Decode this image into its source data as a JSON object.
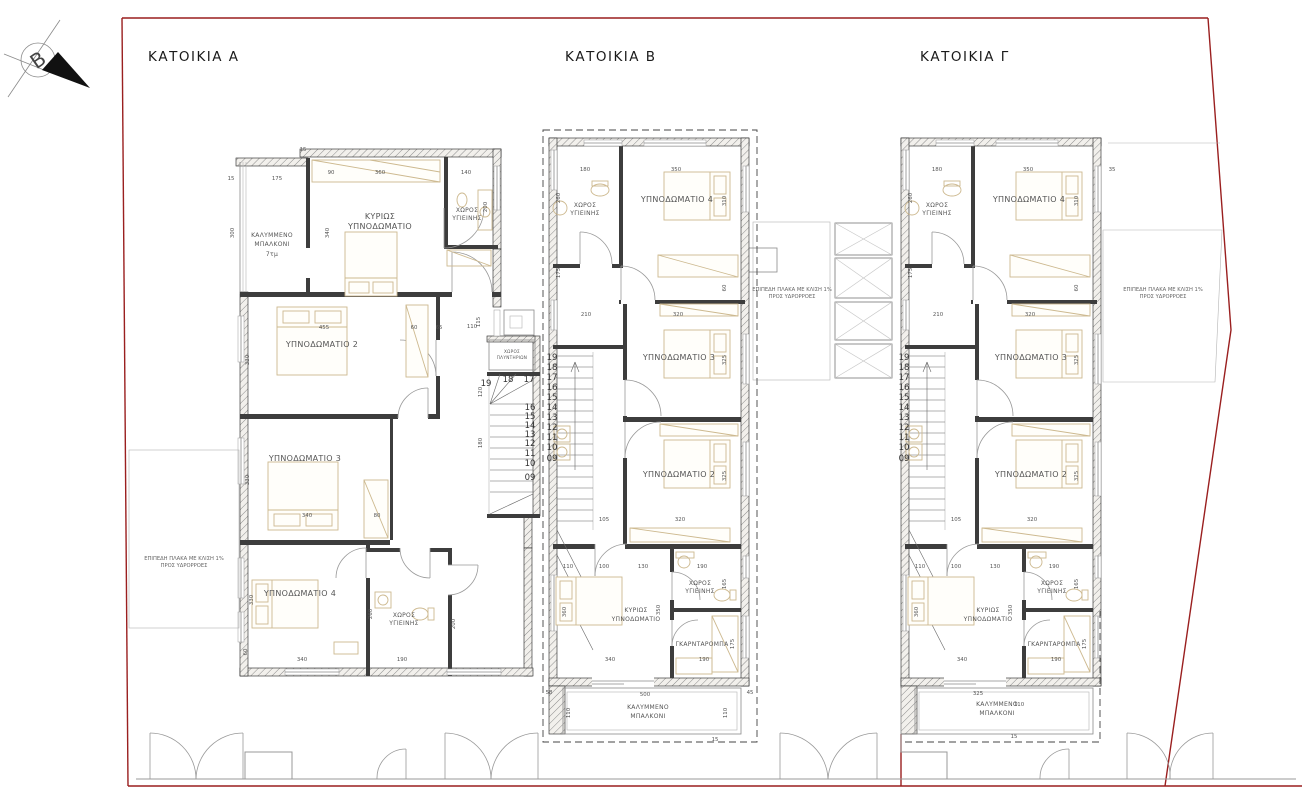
{
  "page": {
    "background": "#ffffff",
    "boundary_color": "#9a1f1f",
    "wall_color": "#3d3d3d",
    "furniture_color": "#cdb98f"
  },
  "north_arrow": {
    "label": "Β"
  },
  "houses": {
    "a": {
      "title": "ΚΑΤΟΙΚΙΑ Α"
    },
    "b": {
      "title": "ΚΑΤΟΙΚΙΑ Β"
    },
    "c": {
      "title": "ΚΑΤΟΙΚΙΑ Γ"
    }
  },
  "labels": {
    "covered_balcony_1": "ΚΑΛΥΜΜΕΝΟ",
    "covered_balcony_2": "ΜΠΑΛΚΟΝΙ",
    "balcony_area_a": "7τμ",
    "master_1": "ΚΥΡΙΩΣ",
    "master_2": "ΥΠΝΟΔΩΜΑΤΙΟ",
    "bath_1": "ΧΩΡΟΣ",
    "bath_2": "ΥΓΙΕΙΝΗΣ",
    "bedroom2": "ΥΠΝΟΔΩΜΑΤΙΟ 2",
    "bedroom3": "ΥΠΝΟΔΩΜΑΤΙΟ 3",
    "bedroom4": "ΥΠΝΟΔΩΜΑΤΙΟ 4",
    "wardrobe": "ΓΚΑΡΝΤΑΡΟΜΠΑ",
    "laundry_1": "ΧΩΡΟΣ",
    "laundry_2": "ΠΛΥΝΤΗΡΙΩΝ",
    "flat_slab_1": "ΕΠΙΠΕΔΗ ΠΛΑΚΑ ΜΕ ΚΛΙΣΗ 1%",
    "flat_slab_2": "ΠΡΟΣ ΥΔΡΟΡΡΟΕΣ"
  },
  "stairs": {
    "numbers": [
      "19",
      "18",
      "17",
      "16",
      "15",
      "14",
      "13",
      "12",
      "11",
      "10",
      "09"
    ]
  },
  "dimensions": {
    "a": [
      {
        "t": "15",
        "x": 231,
        "y": 180
      },
      {
        "t": "175",
        "x": 277,
        "y": 180
      },
      {
        "t": "15",
        "x": 303,
        "y": 151
      },
      {
        "t": "90",
        "x": 331,
        "y": 174
      },
      {
        "t": "360",
        "x": 380,
        "y": 174
      },
      {
        "t": "140",
        "x": 466,
        "y": 174
      },
      {
        "t": "300",
        "x": 234,
        "y": 233,
        "v": 1
      },
      {
        "t": "340",
        "x": 329,
        "y": 233,
        "v": 1
      },
      {
        "t": "200",
        "x": 487,
        "y": 207,
        "v": 1
      },
      {
        "t": "455",
        "x": 324,
        "y": 329
      },
      {
        "t": "60",
        "x": 414,
        "y": 329
      },
      {
        "t": "65",
        "x": 439,
        "y": 329
      },
      {
        "t": "110",
        "x": 472,
        "y": 328
      },
      {
        "t": "330",
        "x": 249,
        "y": 360,
        "v": 1
      },
      {
        "t": "330",
        "x": 249,
        "y": 480,
        "v": 1
      },
      {
        "t": "330",
        "x": 253,
        "y": 600,
        "v": 1
      },
      {
        "t": "340",
        "x": 307,
        "y": 517
      },
      {
        "t": "80",
        "x": 377,
        "y": 517
      },
      {
        "t": "340",
        "x": 302,
        "y": 661
      },
      {
        "t": "190",
        "x": 402,
        "y": 661
      },
      {
        "t": "60",
        "x": 247,
        "y": 652,
        "v": 1
      },
      {
        "t": "115",
        "x": 480,
        "y": 322,
        "v": 1
      },
      {
        "t": "120",
        "x": 482,
        "y": 392,
        "v": 1
      },
      {
        "t": "180",
        "x": 482,
        "y": 443,
        "v": 1
      },
      {
        "t": "260",
        "x": 372,
        "y": 614,
        "v": 1
      },
      {
        "t": "200",
        "x": 455,
        "y": 624,
        "v": 1
      }
    ],
    "b": [
      {
        "t": "180",
        "x": 585,
        "y": 171
      },
      {
        "t": "350",
        "x": 676,
        "y": 171
      },
      {
        "t": "260",
        "x": 560,
        "y": 198,
        "v": 1
      },
      {
        "t": "310",
        "x": 726,
        "y": 201,
        "v": 1
      },
      {
        "t": "175",
        "x": 560,
        "y": 273,
        "v": 1
      },
      {
        "t": "210",
        "x": 586,
        "y": 316
      },
      {
        "t": "320",
        "x": 678,
        "y": 316
      },
      {
        "t": "60",
        "x": 726,
        "y": 288,
        "v": 1
      },
      {
        "t": "325",
        "x": 726,
        "y": 360,
        "v": 1
      },
      {
        "t": "325",
        "x": 726,
        "y": 476,
        "v": 1
      },
      {
        "t": "105",
        "x": 604,
        "y": 521
      },
      {
        "t": "320",
        "x": 680,
        "y": 521
      },
      {
        "t": "110",
        "x": 568,
        "y": 568
      },
      {
        "t": "100",
        "x": 604,
        "y": 568
      },
      {
        "t": "130",
        "x": 643,
        "y": 568
      },
      {
        "t": "190",
        "x": 702,
        "y": 568
      },
      {
        "t": "165",
        "x": 726,
        "y": 584,
        "v": 1
      },
      {
        "t": "360",
        "x": 566,
        "y": 612,
        "v": 1
      },
      {
        "t": "350",
        "x": 660,
        "y": 610,
        "v": 1
      },
      {
        "t": "175",
        "x": 734,
        "y": 644,
        "v": 1
      },
      {
        "t": "340",
        "x": 610,
        "y": 661
      },
      {
        "t": "190",
        "x": 704,
        "y": 661
      },
      {
        "t": "500",
        "x": 645,
        "y": 696
      },
      {
        "t": "110",
        "x": 570,
        "y": 713,
        "v": 1
      },
      {
        "t": "110",
        "x": 727,
        "y": 713,
        "v": 1
      },
      {
        "t": "58",
        "x": 549,
        "y": 694
      },
      {
        "t": "45",
        "x": 750,
        "y": 694
      },
      {
        "t": "15",
        "x": 715,
        "y": 741
      }
    ],
    "c": [
      {
        "t": "180",
        "x": 937,
        "y": 171
      },
      {
        "t": "350",
        "x": 1028,
        "y": 171
      },
      {
        "t": "35",
        "x": 1112,
        "y": 171
      },
      {
        "t": "260",
        "x": 912,
        "y": 198,
        "v": 1
      },
      {
        "t": "310",
        "x": 1078,
        "y": 201,
        "v": 1
      },
      {
        "t": "175",
        "x": 912,
        "y": 273,
        "v": 1
      },
      {
        "t": "210",
        "x": 938,
        "y": 316
      },
      {
        "t": "320",
        "x": 1030,
        "y": 316
      },
      {
        "t": "60",
        "x": 1078,
        "y": 288,
        "v": 1
      },
      {
        "t": "325",
        "x": 1078,
        "y": 360,
        "v": 1
      },
      {
        "t": "325",
        "x": 1078,
        "y": 476,
        "v": 1
      },
      {
        "t": "105",
        "x": 956,
        "y": 521
      },
      {
        "t": "320",
        "x": 1032,
        "y": 521
      },
      {
        "t": "110",
        "x": 920,
        "y": 568
      },
      {
        "t": "100",
        "x": 956,
        "y": 568
      },
      {
        "t": "130",
        "x": 995,
        "y": 568
      },
      {
        "t": "190",
        "x": 1054,
        "y": 568
      },
      {
        "t": "165",
        "x": 1078,
        "y": 584,
        "v": 1
      },
      {
        "t": "360",
        "x": 918,
        "y": 612,
        "v": 1
      },
      {
        "t": "350",
        "x": 1012,
        "y": 610,
        "v": 1
      },
      {
        "t": "175",
        "x": 1086,
        "y": 644,
        "v": 1
      },
      {
        "t": "340",
        "x": 962,
        "y": 661
      },
      {
        "t": "190",
        "x": 1056,
        "y": 661
      },
      {
        "t": "325",
        "x": 978,
        "y": 695
      },
      {
        "t": "110",
        "x": 1019,
        "y": 706
      },
      {
        "t": "15",
        "x": 1014,
        "y": 738
      }
    ]
  }
}
